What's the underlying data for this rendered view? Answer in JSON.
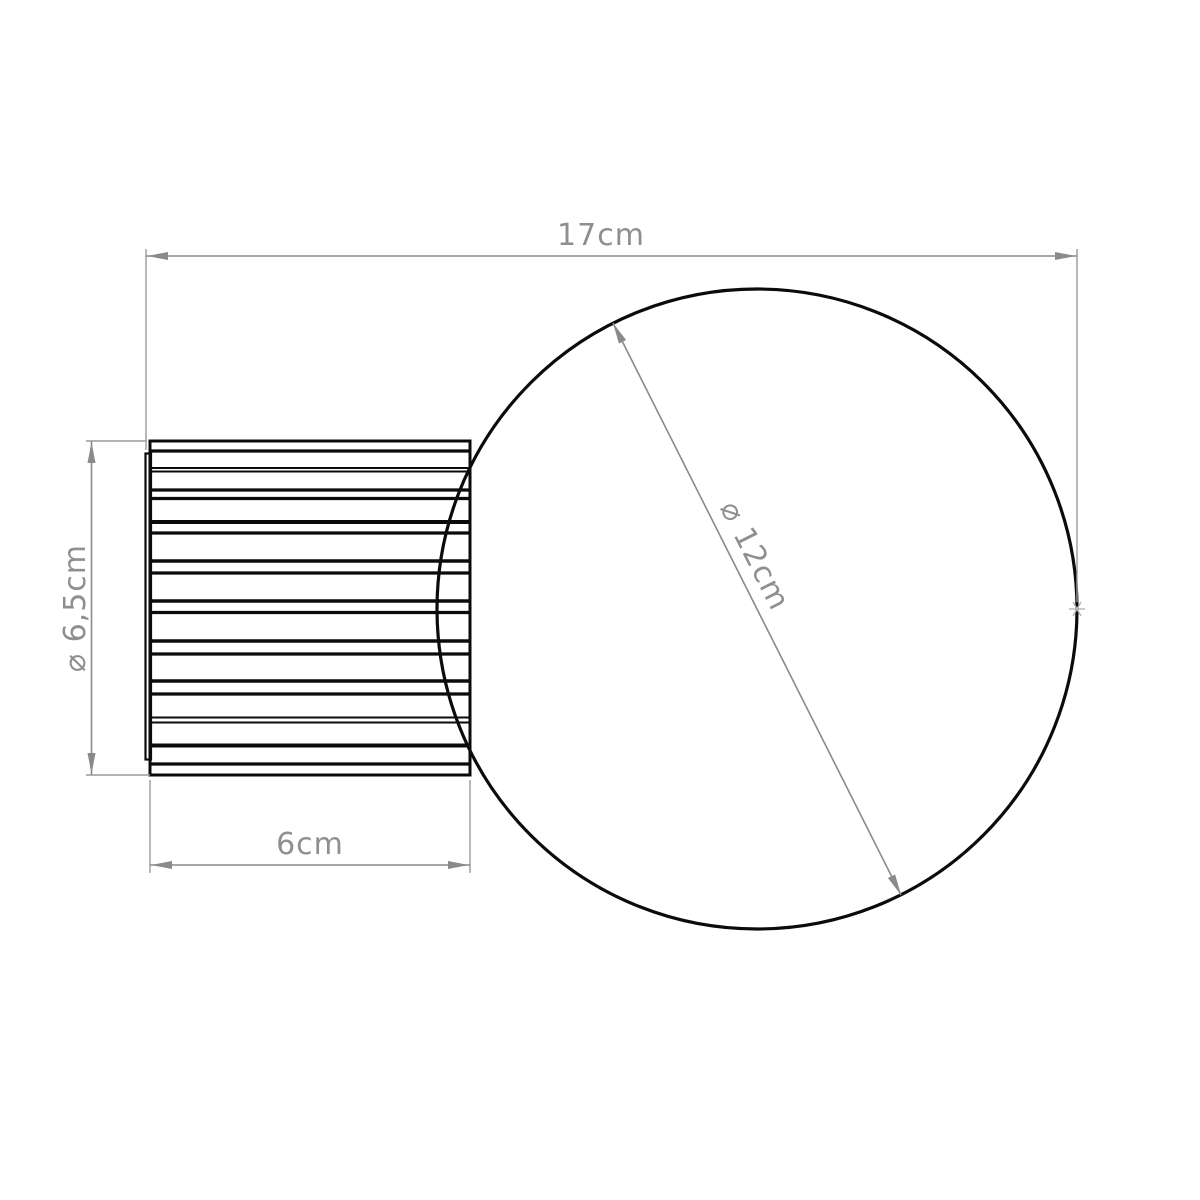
{
  "sheet": {
    "background": "#ffffff",
    "outline_color": "#0b0b0b",
    "dimension_line_color": "#8a8a8a",
    "dimension_label_color": "#8f8f8f"
  },
  "dimensions": {
    "overall_width": {
      "label": "17cm",
      "value_cm": 17,
      "orientation": "horizontal"
    },
    "base_diameter": {
      "label": "⌀ 6,5cm",
      "value_cm": 6.5,
      "orientation": "vertical"
    },
    "base_length": {
      "label": "6cm",
      "value_cm": 6,
      "orientation": "horizontal"
    },
    "globe_diameter": {
      "label": "⌀ 12cm",
      "value_cm": 12,
      "orientation": "diagonal"
    }
  }
}
